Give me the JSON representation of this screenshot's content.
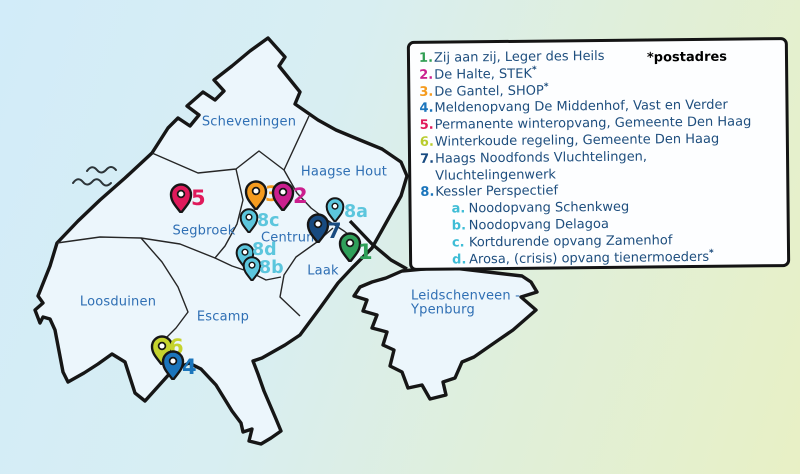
{
  "legend": {
    "note": "*postadres",
    "text_color": "#1e4e7e",
    "sub_color": "#3fbdd6",
    "items": [
      {
        "num": "1.",
        "color": "#2f9e53",
        "text": "Zij aan zij, Leger des Heils",
        "asterisk": false
      },
      {
        "num": "2.",
        "color": "#cb1f8e",
        "text": "De Halte, STEK",
        "asterisk": true
      },
      {
        "num": "3.",
        "color": "#f59b1f",
        "text": "De Gantel, SHOP",
        "asterisk": true
      },
      {
        "num": "4.",
        "color": "#1b75bc",
        "text": "Meldenopvang De Middenhof, Vast en Verder",
        "asterisk": false
      },
      {
        "num": "5.",
        "color": "#e01a5b",
        "text": "Permanente winteropvang, Gemeente Den Haag",
        "asterisk": false
      },
      {
        "num": "6.",
        "color": "#b9cc2e",
        "text": "Winterkoude regeling, Gemeente Den Haag",
        "asterisk": false
      },
      {
        "num": "7.",
        "color": "#174a80",
        "text": "Haags Noodfonds Vluchtelingen,",
        "text2": "Vluchtelingenwerk",
        "asterisk": false
      },
      {
        "num": "8.",
        "color": "#1b75bc",
        "text": "Kessler Perspectief",
        "asterisk": false,
        "sub": [
          {
            "letter": "a.",
            "text": "Noodopvang Schenkweg",
            "asterisk": false
          },
          {
            "letter": "b.",
            "text": "Noodopvang Delagoa",
            "asterisk": false
          },
          {
            "letter": "c.",
            "text": "Kortdurende opvang Zamenhof",
            "asterisk": false
          },
          {
            "letter": "d.",
            "text": "Arosa, (crisis) opvang tienermoeders",
            "asterisk": true
          }
        ]
      }
    ]
  },
  "map": {
    "district_label_color": "#2f6fb4",
    "districts": [
      {
        "name": "Scheveningen",
        "x": 249,
        "y": 122
      },
      {
        "name": "Haagse Hout",
        "x": 344,
        "y": 172
      },
      {
        "name": "Segbroek",
        "x": 204,
        "y": 231
      },
      {
        "name": "Centrum",
        "x": 290,
        "y": 238
      },
      {
        "name": "Laak",
        "x": 323,
        "y": 271
      },
      {
        "name": "Loosduinen",
        "x": 118,
        "y": 302
      },
      {
        "name": "Escamp",
        "x": 223,
        "y": 317
      },
      {
        "name": "Leidschenveen -",
        "x": 411,
        "y": 296,
        "align": "left"
      },
      {
        "name": "Ypenburg",
        "x": 411,
        "y": 310,
        "align": "left"
      }
    ],
    "pins": [
      {
        "id": "5",
        "label": "5",
        "color": "#e01a5b",
        "x": 181,
        "y": 213,
        "lx": 191,
        "ly": 198,
        "size": "lg"
      },
      {
        "id": "3",
        "label": "3",
        "color": "#f59b1f",
        "x": 256,
        "y": 210,
        "lx": 265,
        "ly": 194,
        "size": "lg"
      },
      {
        "id": "2",
        "label": "2",
        "color": "#cb1f8e",
        "x": 283,
        "y": 211,
        "lx": 293,
        "ly": 196,
        "size": "lg"
      },
      {
        "id": "8a",
        "label": "8a",
        "color": "#5cc6dd",
        "x": 335,
        "y": 222,
        "lx": 344,
        "ly": 212,
        "size": "sm"
      },
      {
        "id": "8c",
        "label": "8c",
        "color": "#5cc6dd",
        "x": 249,
        "y": 233,
        "lx": 257,
        "ly": 221,
        "size": "sm"
      },
      {
        "id": "8d",
        "label": "8d",
        "color": "#5cc6dd",
        "x": 245,
        "y": 268,
        "lx": 252,
        "ly": 250,
        "size": "sm"
      },
      {
        "id": "8b",
        "label": "8b",
        "color": "#5cc6dd",
        "x": 252,
        "y": 281,
        "lx": 259,
        "ly": 268,
        "size": "sm"
      },
      {
        "id": "7",
        "label": "7",
        "color": "#174a80",
        "x": 318,
        "y": 243,
        "lx": 327,
        "ly": 231,
        "size": "lg"
      },
      {
        "id": "1",
        "label": "1",
        "color": "#2fa05a",
        "x": 350,
        "y": 262,
        "lx": 358,
        "ly": 252,
        "size": "lg"
      },
      {
        "id": "6",
        "label": "6",
        "color": "#c5d32e",
        "x": 162,
        "y": 365,
        "lx": 169,
        "ly": 347,
        "size": "lg"
      },
      {
        "id": "4",
        "label": "4",
        "color": "#1b75bc",
        "x": 173,
        "y": 380,
        "lx": 182,
        "ly": 367,
        "size": "lg"
      }
    ]
  }
}
